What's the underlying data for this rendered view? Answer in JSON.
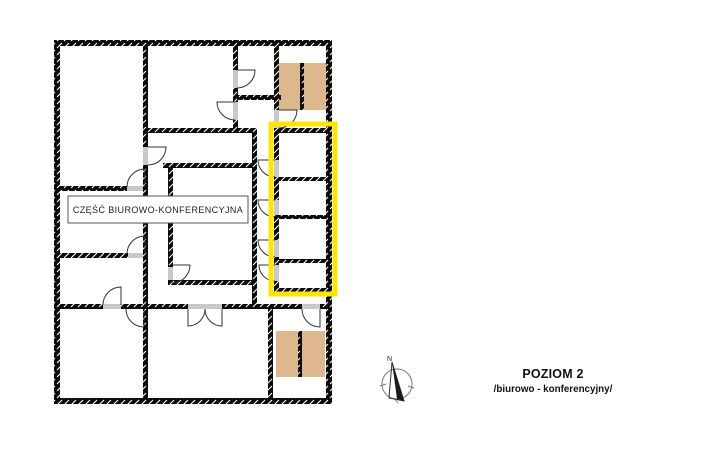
{
  "plan": {
    "area_label": "CZĘŚĆ BIUROWO-KONFERENCYJNA",
    "colors": {
      "highlight": "#FFE500",
      "stairs": "#DDB88F",
      "wall": "#000000"
    }
  },
  "legend": {
    "title": "POZIOM 2",
    "subtitle": "/biurowo - konferencyjny/"
  },
  "compass": {
    "label": "N"
  }
}
